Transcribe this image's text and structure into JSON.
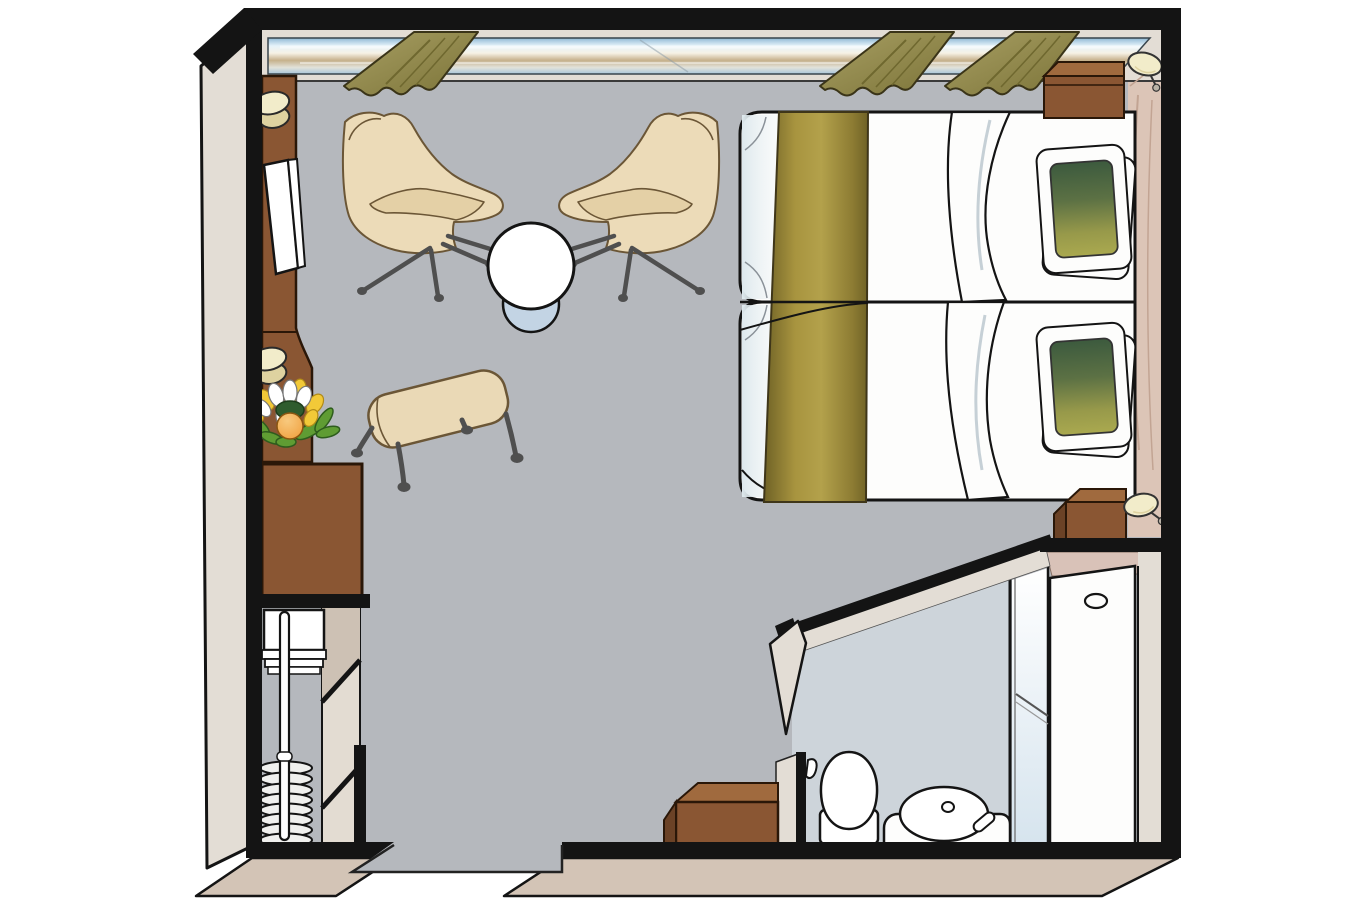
{
  "meta": {
    "type": "floor-plan",
    "subject": "cruise-ship-stateroom-cabin",
    "view": "top-down-isometric",
    "visible_text": "none"
  },
  "palette": {
    "page_bg": "#ffffff",
    "line": "#141414",
    "floor": "#b5b8bd",
    "wall_face": "#e3ddd5",
    "skirt": "#d3c4b6",
    "wood": "#8a5633",
    "wood_light": "#a06a3e",
    "wood_dark": "#6b4226",
    "wood_line": "#2a1708",
    "headboard": "#dcc5b7",
    "headboard_line": "#c2a493",
    "gold_1": "#6f6226",
    "gold_2": "#a8943f",
    "gold_3": "#b3a14b",
    "gold_4": "#8d7c33",
    "duvet_shade": "#dde8ed",
    "green_1": "#3c5a3e",
    "green_2": "#5c7144",
    "green_3": "#97994a",
    "green_4": "#aaa94f",
    "chair": "#ecdbb8",
    "chair_cushion": "#e4d0a6",
    "chair_line": "#6b5636",
    "leg": "#4f4f4f",
    "bench": "#ead9b6",
    "stool": "#c3d4e4",
    "curtain_1": "#a89f63",
    "curtain_2": "#7b7338",
    "curtain_line": "#3a3418",
    "curtain_fold": "#6f682f",
    "window_1": "#8fb8d4",
    "window_2": "#e6f3fa",
    "window_3": "#f6f2e5",
    "window_4": "#c6b18c",
    "window_5": "#e2e2da",
    "window_6": "#a9c6da",
    "bath_floor": "#cdd4da",
    "glass_1": "#ffffff",
    "glass_2": "#d6e4ee",
    "white": "#fdfdfc",
    "pink_wall": "#d9c2b8",
    "lamp": "#f2ecca",
    "lamp_dark": "#ded2a0",
    "shelf_beige": "#e3dcd2",
    "shelf_dark": "#cdc1b4",
    "flower_white": "#ffffff",
    "flower_yellow": "#f2c938",
    "flower_green": "#5f9c33",
    "flower_green_dark": "#2f5c2e",
    "flower_orange": "#ef9d3a"
  },
  "plan": {
    "areas": [
      {
        "id": "main-cabin",
        "name": "main cabin"
      },
      {
        "id": "bathroom",
        "name": "bathroom"
      },
      {
        "id": "wardrobe",
        "name": "wardrobe closet"
      },
      {
        "id": "entrance",
        "name": "entrance doorway"
      }
    ],
    "furniture": [
      {
        "id": "panoramic-window",
        "name": "panoramic window with curtains",
        "curtains": 3
      },
      {
        "id": "armchairs",
        "name": "swivel armchairs",
        "count": 2
      },
      {
        "id": "coffee-table",
        "name": "round table"
      },
      {
        "id": "footstool",
        "name": "round footstool"
      },
      {
        "id": "bench",
        "name": "upholstered bench"
      },
      {
        "id": "twin-beds",
        "name": "twin beds with gold runner and green pillows",
        "count": 2
      },
      {
        "id": "nightstands",
        "name": "nightstands with wall lamps",
        "count": 2
      },
      {
        "id": "tv-console",
        "name": "console with TV, cups and flower vase"
      },
      {
        "id": "dresser",
        "name": "dresser cabinet"
      },
      {
        "id": "closet-fittings",
        "name": "shelves, hanging rail and hangers"
      },
      {
        "id": "toilet",
        "name": "toilet"
      },
      {
        "id": "washbasin",
        "name": "vanity washbasin"
      },
      {
        "id": "shower",
        "name": "shower with glass door"
      },
      {
        "id": "bath-cabinet",
        "name": "bathroom cabinet"
      }
    ]
  }
}
